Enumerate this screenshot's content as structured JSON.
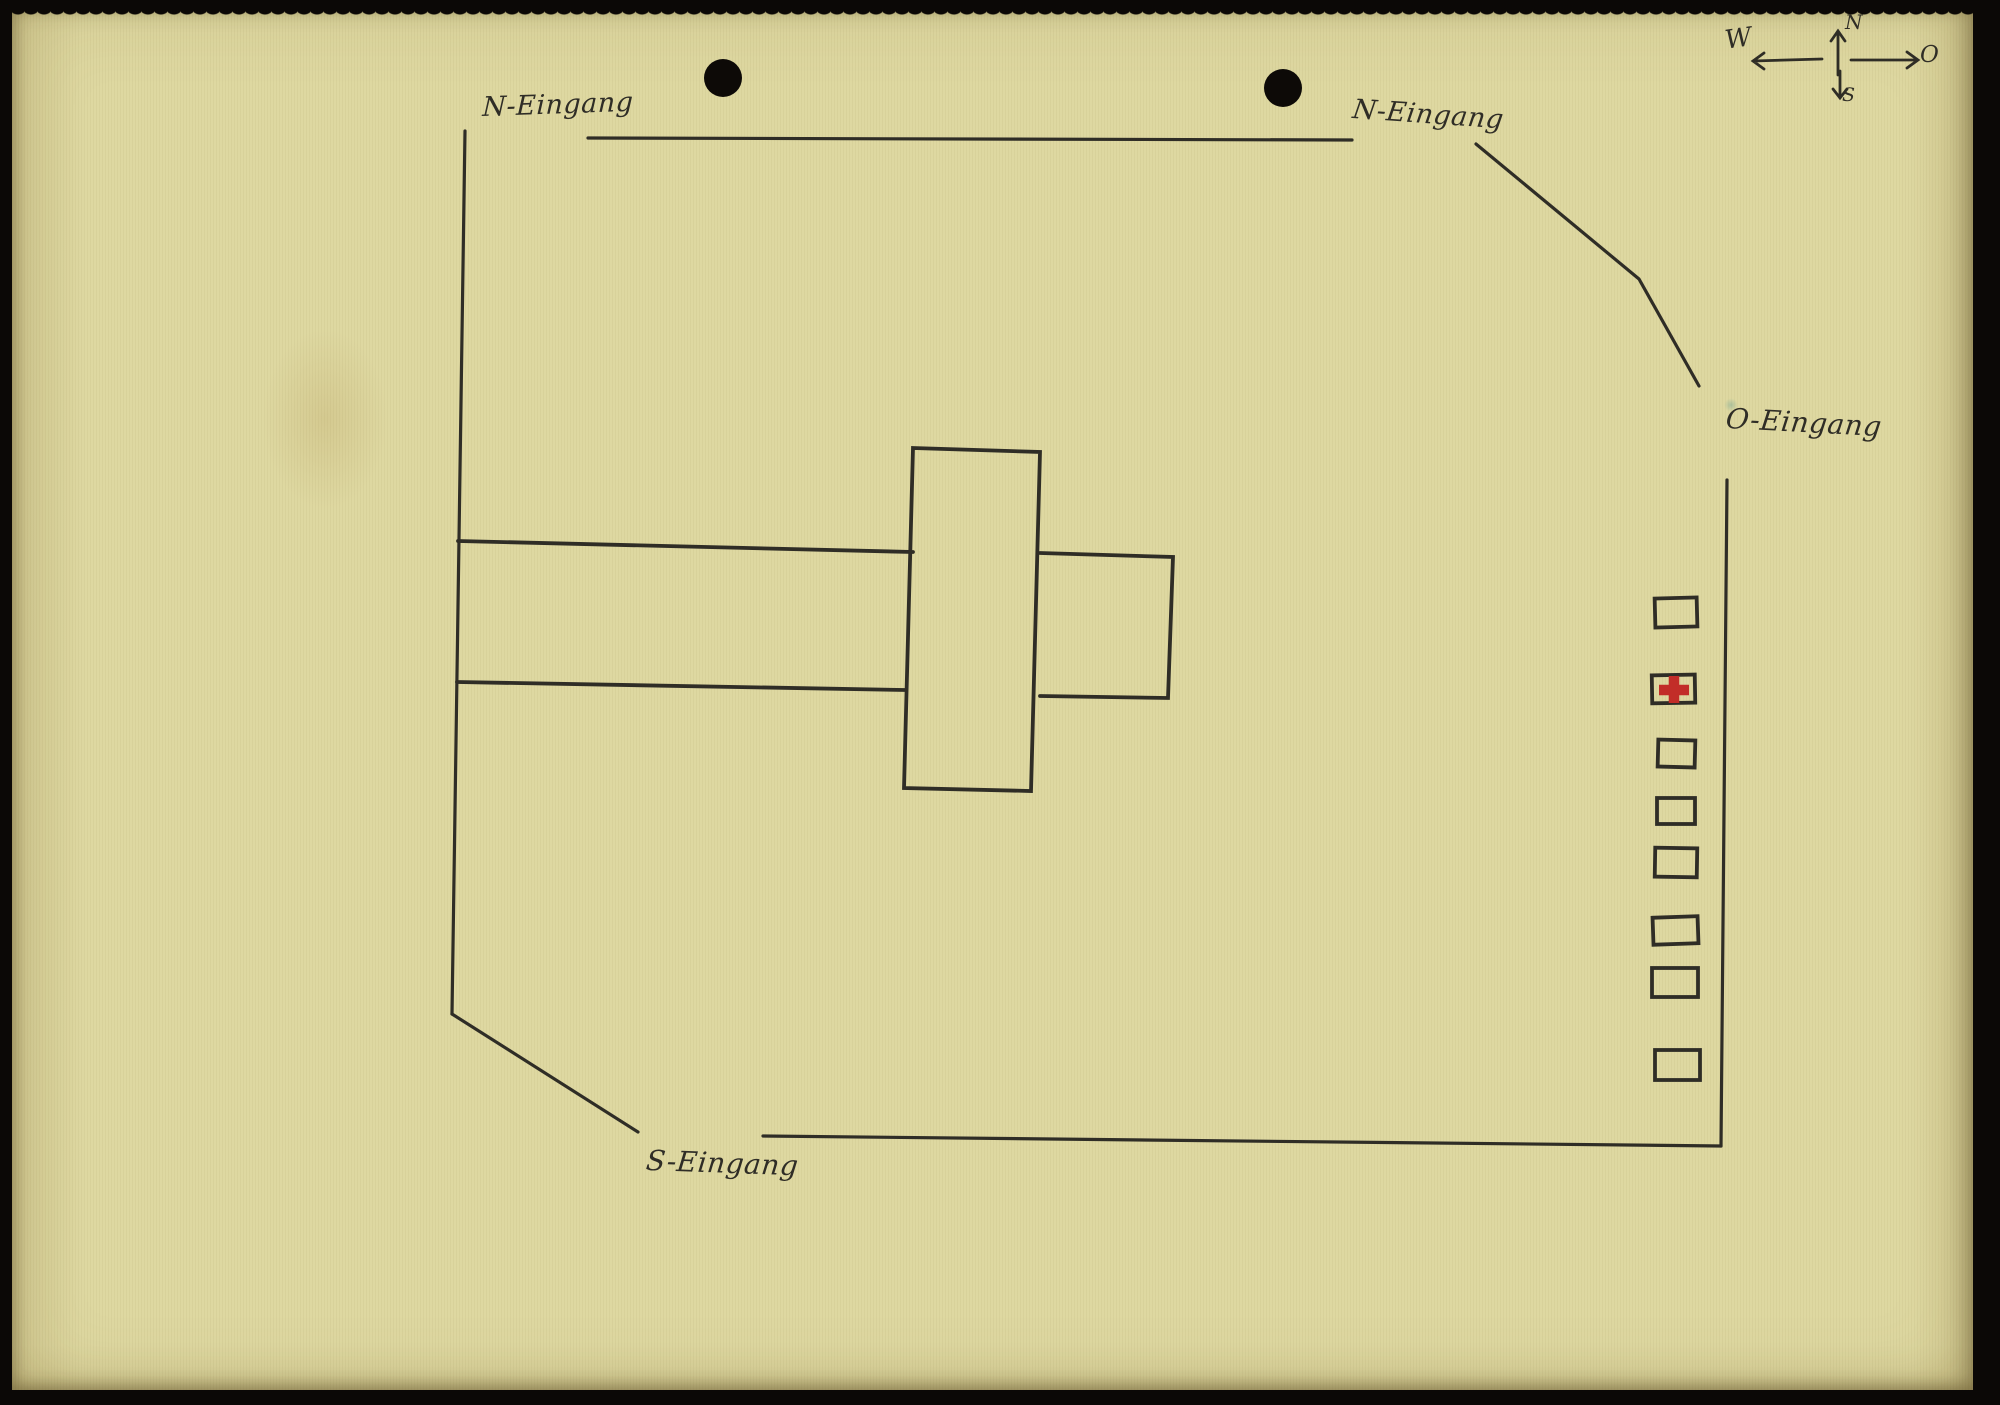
{
  "colors": {
    "background": "#0b0806",
    "paper": "#ded8a1",
    "ink": "#2f2d26",
    "red_cross": "#c22d28",
    "punch_hole": "#0d0a07"
  },
  "compass": {
    "north": "N",
    "east": "O",
    "south": "S",
    "west": "W"
  },
  "entrances": {
    "north_west": "N-Eingang",
    "north_east": "N-Eingang",
    "east": "O-Eingang",
    "south": "S-Eingang"
  },
  "outbuildings": {
    "count": 8,
    "medical_marker": "red-cross",
    "medical_marker_position": 2
  }
}
